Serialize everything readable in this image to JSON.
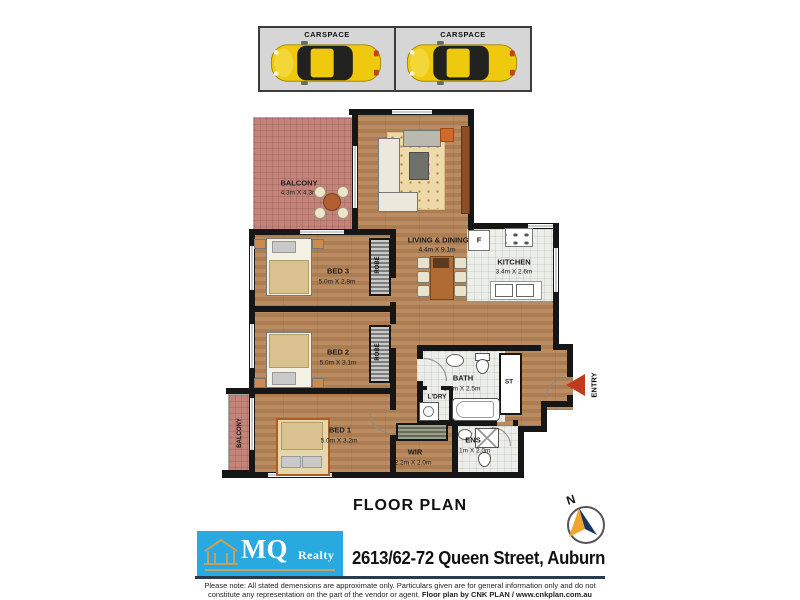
{
  "colors": {
    "logo_blue": "#28a9e0",
    "logo_gold": "#c8a05e",
    "entry_red": "#c03a1e",
    "compass_navy": "#15365f",
    "compass_orange": "#f2a431",
    "wall_black": "#161616",
    "wood_floor": "#b5875d",
    "balcony_tile": "#c5847a",
    "wet_area_tile": "#eceee9",
    "rug_tan": "#eed9a8",
    "car_yellow": "#eec90e"
  },
  "carspaces": {
    "items": [
      {
        "label": "CARSPACE"
      },
      {
        "label": "CARSPACE"
      }
    ]
  },
  "rooms": {
    "balcony_main": {
      "name": "BALCONY",
      "dims": "4.3m X 4.3m"
    },
    "living_dining": {
      "name": "LIVING & DINING",
      "dims": "4.4m X 9.1m"
    },
    "kitchen": {
      "name": "KITCHEN",
      "dims": "3.4m X 2.6m"
    },
    "bed3": {
      "name": "BED 3",
      "dims": "5.0m X 2.8m"
    },
    "bed2": {
      "name": "BED 2",
      "dims": "5.0m X 3.1m"
    },
    "bed1": {
      "name": "BED 1",
      "dims": "5.0m X 3.2m"
    },
    "bath": {
      "name": "BATH",
      "dims": "3.2m X 2.5m"
    },
    "ens": {
      "name": "ENS",
      "dims": "2.1m X 2.0m"
    },
    "wir": {
      "name": "WIR",
      "dims": "2.2m X 2.0m"
    },
    "laundry": {
      "name": "L'DRY"
    },
    "storage": {
      "name": "ST"
    },
    "robe": {
      "name": "ROBE"
    },
    "balcony_side": {
      "name": "BALCONY"
    },
    "entry": {
      "name": "ENTRY"
    },
    "fridge": {
      "name": "F"
    }
  },
  "titles": {
    "floor_plan": "FLOOR PLAN",
    "address": "2613/62-72 Queen Street, Auburn"
  },
  "logo": {
    "mq": "MQ",
    "realty": "Realty"
  },
  "compass": {
    "north": "N"
  },
  "footer": {
    "line1": "Please note: All stated demensions are approximate only. Particulars given are for general information only and do not",
    "line2_normal": "constitute any representation on the part of the vendor or agent. ",
    "line2_bold": "Floor plan by CNK PLAN / www.cnkplan.com.au"
  }
}
